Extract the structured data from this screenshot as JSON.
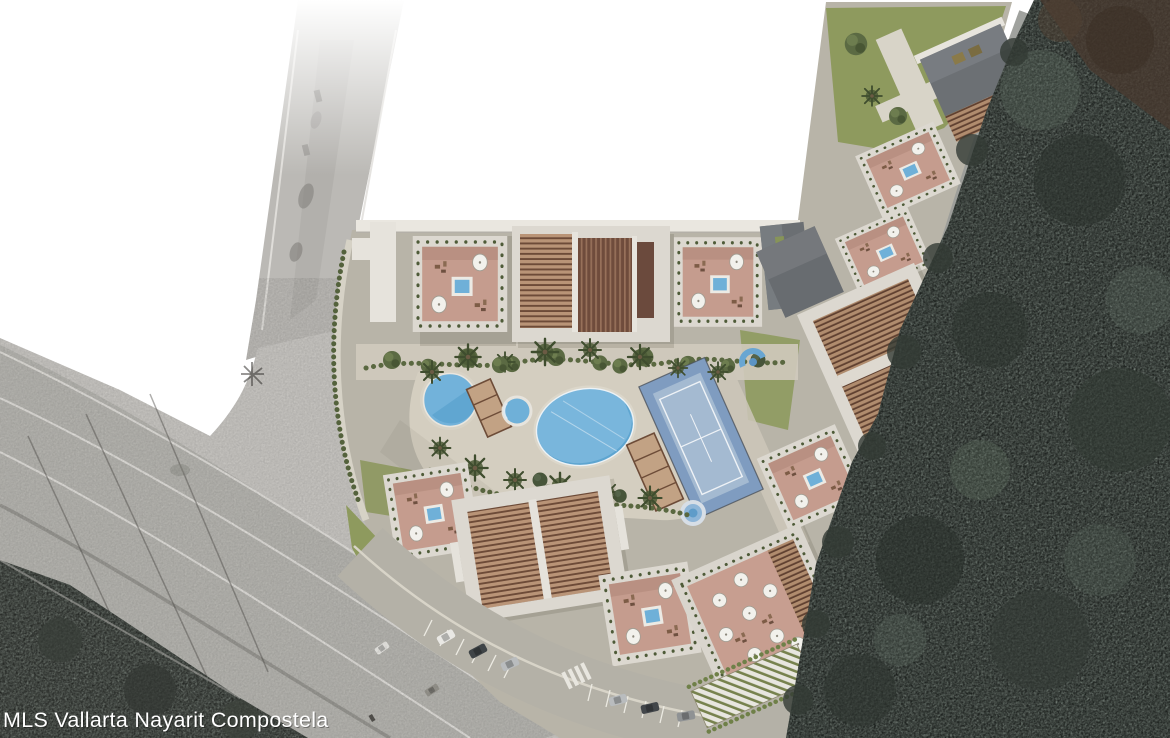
{
  "watermark": {
    "text": "MLS Vallarta Nayarit Compostela"
  },
  "scene": {
    "kind": "aerial-site-plan-rendering",
    "labels": {
      "site": "condo-development-site-plan",
      "forest": "dense-forest-east",
      "highway": "highway-interchange-west",
      "pools": "swimming-pools",
      "court": "paddle-court",
      "parking": "street-parking",
      "restaurant_terrace": "umbrella-terrace",
      "rooftops": "rooftop-terraces-with-plunge-pools"
    }
  },
  "colors": {
    "white": "#ffffff",
    "aerial_base": "#c7c5c1",
    "aerial_band": "#bbb9b5",
    "aerial_road": "#b2b0ac",
    "lane_line": "#e3e1dd",
    "dark_vegetation": "#454a44",
    "forest_base": "#3a433d",
    "forest_dark": "#2d342f",
    "forest_light": "#5c6a5f",
    "forest_brown": "#4a3a2f",
    "site_ground": "#b8b4a8",
    "path_light": "#d0cabc",
    "lawn": "#8e9a5e",
    "hedge": "#54623c",
    "building_white": "#e7e4dd",
    "building_frame": "#dcd8d0",
    "terrace_pink": "#c59c8e",
    "pergola_light": "#b99477",
    "pergola_dark": "#6b4a3d",
    "slate_roof": "#6b6f73",
    "pool_blue": "#72b2da",
    "pool_deep": "#58a1cd",
    "court_apron": "#7f9cc0",
    "court_field": "#a4bad1",
    "street_render": "#b4b1a7",
    "umbrella": "#f2f1ec",
    "car_white": "#e9e8e4",
    "car_silver": "#b9bcbe",
    "car_dark": "#3f4447"
  }
}
